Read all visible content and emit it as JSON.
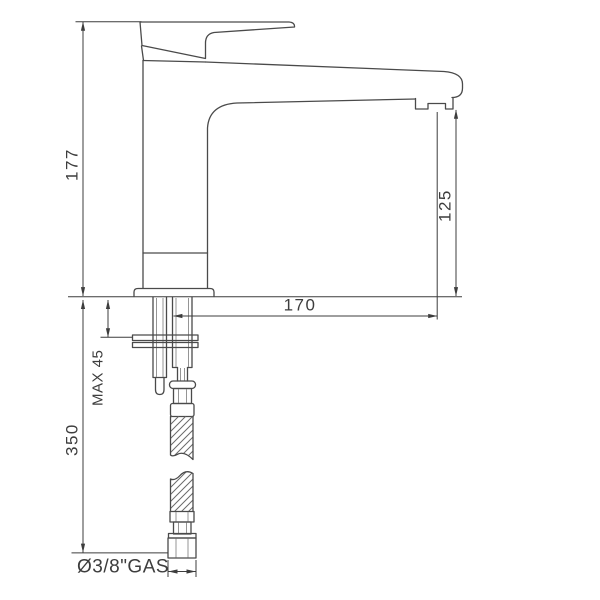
{
  "drawing": {
    "type": "technical-dimension-drawing",
    "subject": "single-lever basin mixer faucet, side elevation",
    "labels": {
      "height_total": "177",
      "spout_height": "125",
      "spout_reach": "170",
      "max_deck_thickness": "MAX 45",
      "hose_length": "350",
      "connection": "Ø3/8\"GAS"
    },
    "dimensions": [
      {
        "label": "177",
        "orientation": "vertical"
      },
      {
        "label": "125",
        "orientation": "vertical"
      },
      {
        "label": "170",
        "orientation": "horizontal"
      },
      {
        "label": "MAX 45",
        "orientation": "vertical"
      },
      {
        "label": "350",
        "orientation": "vertical"
      },
      {
        "label": "Ø3/8\"GAS",
        "orientation": "horizontal"
      }
    ]
  },
  "colors": {
    "background": "#ffffff",
    "object_line": "#4a4a4a",
    "dimension_line": "#3d3d3d",
    "text": "#3d3d3d"
  }
}
